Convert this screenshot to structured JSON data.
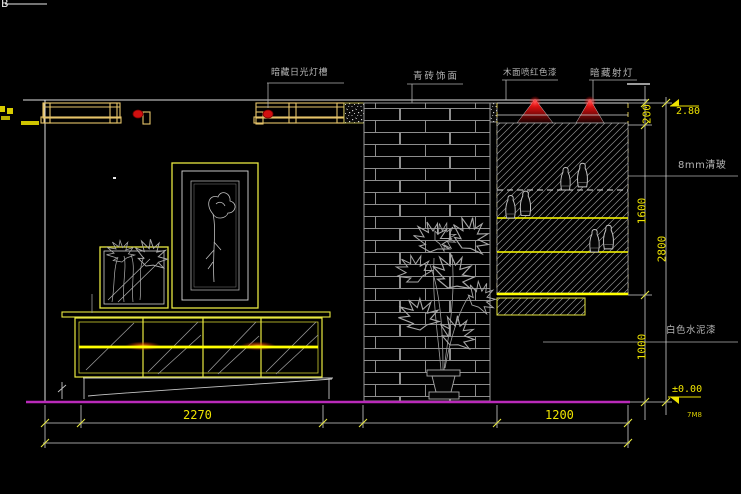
{
  "meta": {
    "drawing_type": "interior elevation CAD drawing",
    "background": "#000000"
  },
  "stamps": {
    "top_left": "B",
    "plot_ref": "7M8"
  },
  "callouts": {
    "light_trough": "暗藏日光灯槽",
    "brick_finish": "青砖饰面",
    "red_wood": "木面喷红色漆",
    "spotlight": "暗藏射灯",
    "glass": "8mm清玻",
    "white_cement": "白色水泥漆"
  },
  "dims": {
    "trough_height": "200",
    "display_height": "1600",
    "base_height": "1000",
    "total_height": "2800",
    "cabinet_width": "2270",
    "unit_width": "1200"
  },
  "levels": {
    "ceiling": "2.80",
    "floor": "±0.00"
  },
  "colors": {
    "line_yellow": "#ffff00",
    "trough_yellow": "#e6c46a",
    "line_white": "#e8e8e8",
    "line_gray": "#9a9a9a",
    "floor_magenta": "#b92ab9",
    "lamp_red": "#d01010",
    "glow_orange": "#ff8a00",
    "text_gray": "#b4b4b4",
    "dim_yellow": "#efe400"
  }
}
